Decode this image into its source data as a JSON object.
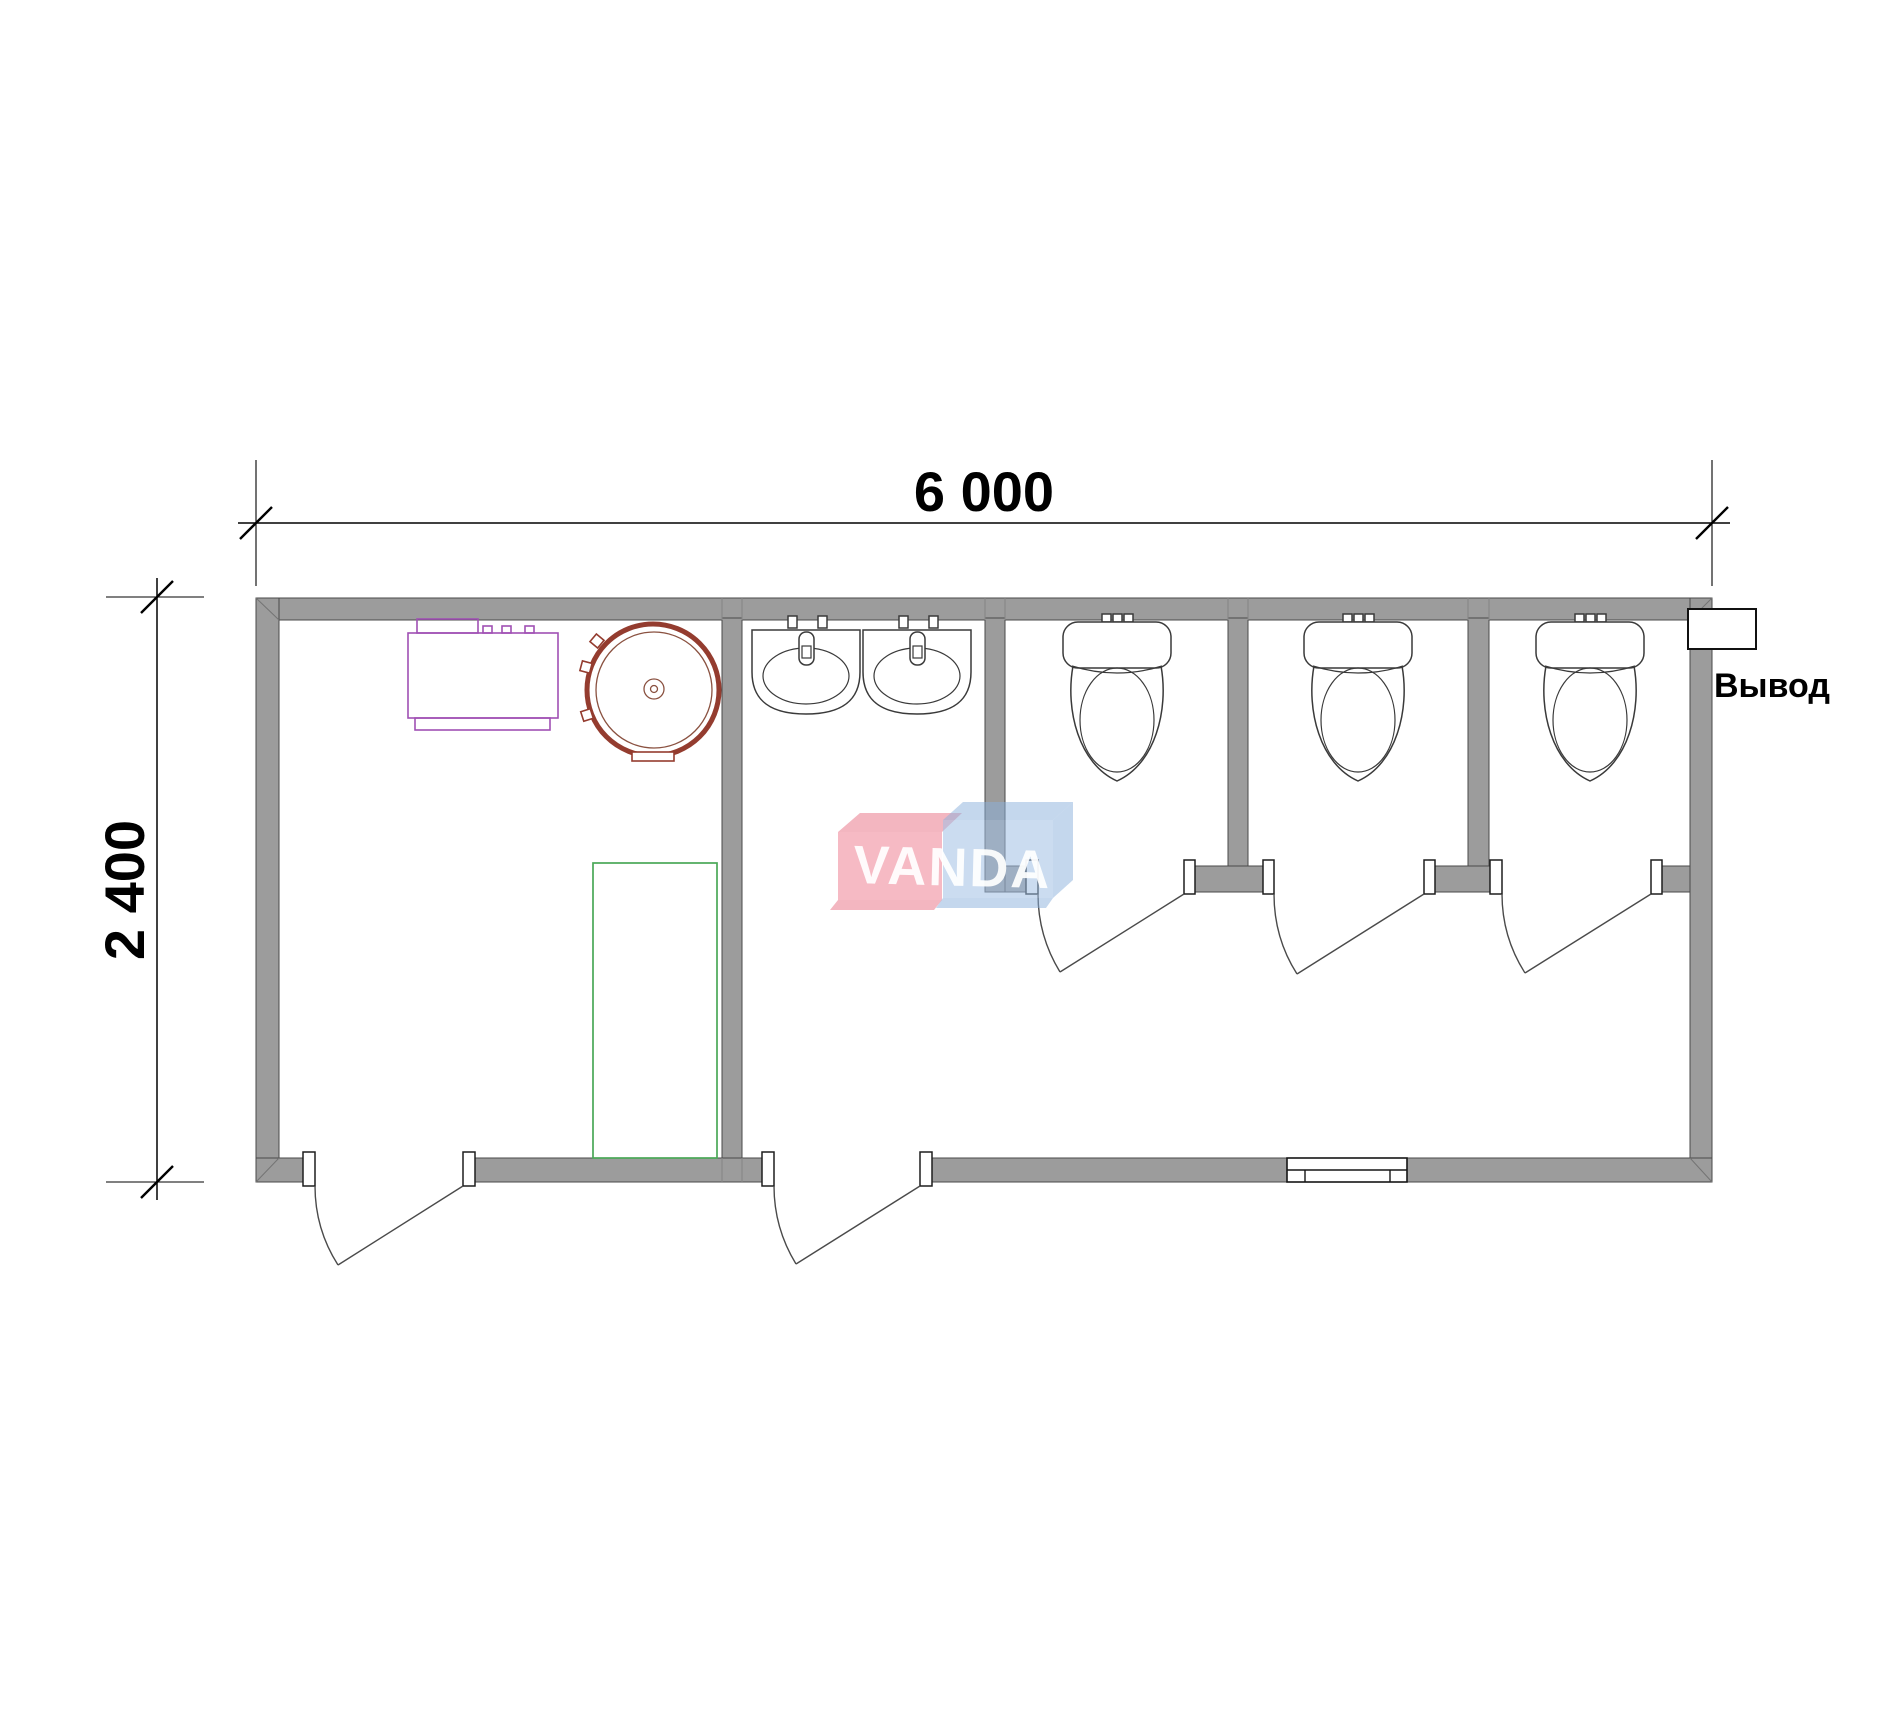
{
  "document": {
    "background": "#ffffff",
    "drawing": "sanitary-container-floor-plan"
  },
  "dimensions": {
    "width_label": "6 000",
    "height_label": "2 400"
  },
  "labels": {
    "outlet": "Вывод"
  },
  "watermark": {
    "text": "VANDA"
  },
  "plan_contents": {
    "toilets": 3,
    "sinks": 2,
    "shower_trays": 1,
    "round_water_heaters": 1,
    "cabinets": 1,
    "swing_doors": 5,
    "windows": 1,
    "toilet_stalls": 3
  },
  "colors": {
    "wall_gray": "#9c9c9c",
    "line_dark": "#4a4a4a",
    "equipment_purple": "#a050b4",
    "equipment_red": "#943c2f",
    "shower_green": "#4aa857",
    "watermark_pink": "rgba(238,130,148,0.55)",
    "watermark_blue": "rgba(160,192,228,0.55)",
    "dim_black": "#000000"
  }
}
